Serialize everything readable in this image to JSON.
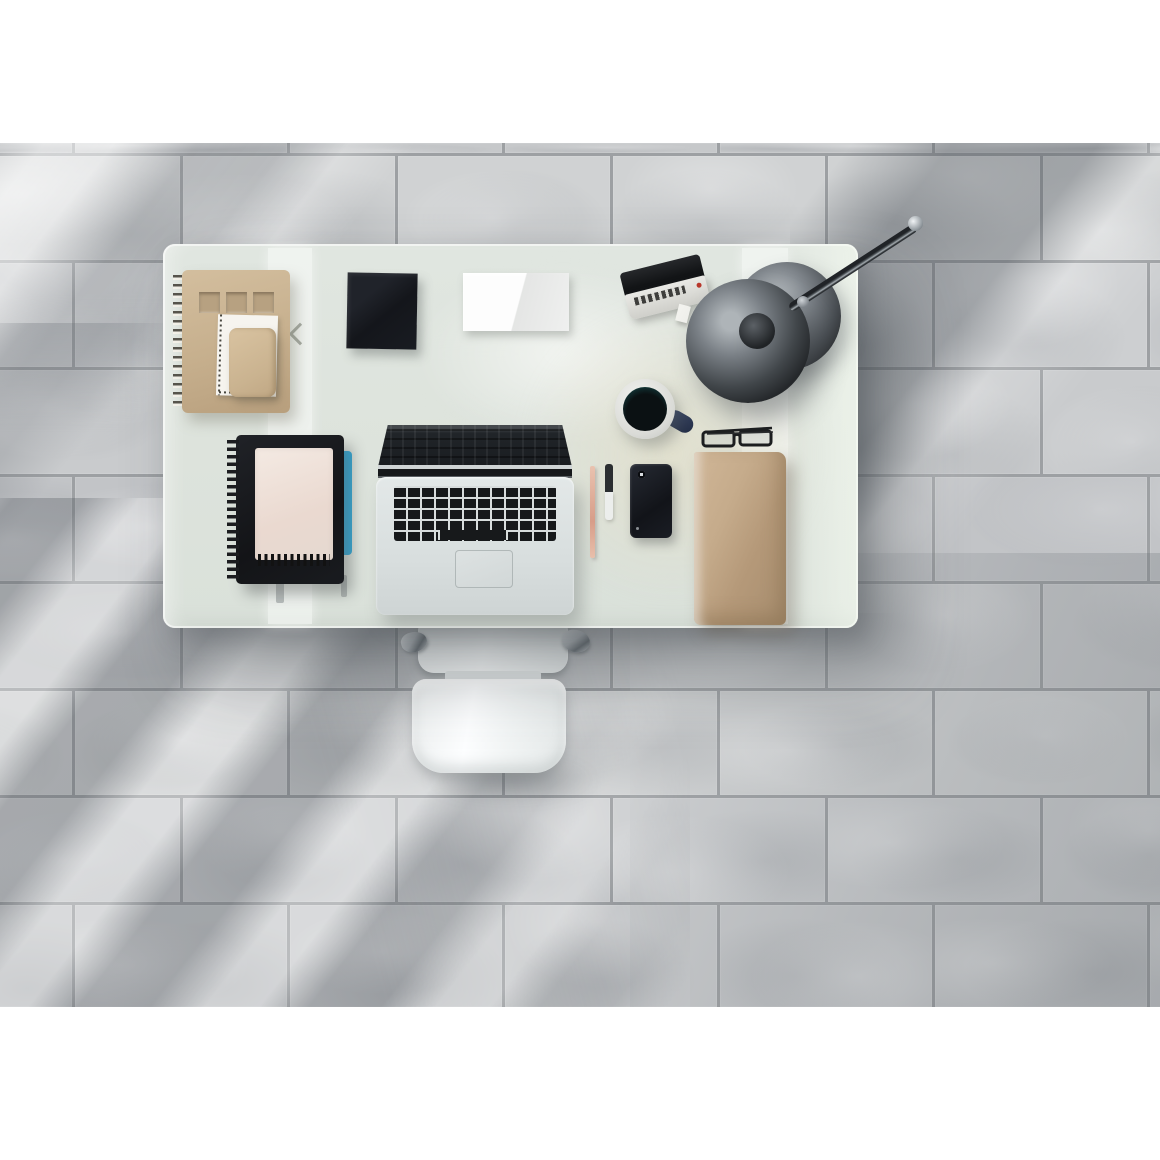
{
  "scene": {
    "description": "Overhead photo of a modern workspace: frosted glass desk with laptop and stationery on a gray stone tile floor, white office chair tucked under the desk, diagonal window light streaks across the tiles.",
    "photo_frame": {
      "top_margin_px": 143,
      "photo_height_px": 864,
      "margin_color": "#ffffff"
    }
  },
  "floor": {
    "label": "gray stone tile floor",
    "height": 864,
    "first_line": 10,
    "row_height": 107,
    "tile_w": 215,
    "grout": 3,
    "offsets": [
      72,
      180
    ],
    "grout_color": "#9da0a3",
    "palette": [
      "#c6c8ca",
      "#cdcfd1",
      "#c2c4c7",
      "#d0d2d3",
      "#c9cbcd"
    ]
  },
  "objects": {
    "floor": {
      "label": "gray stone tile floor"
    },
    "desk": {
      "label": "frosted glass desk"
    },
    "chair": {
      "label": "white office chair"
    },
    "laptop": {
      "label": "open laptop with black keyboard"
    },
    "spiral_notebook_tan": {
      "label": "tan spiral notebook with window cut-out cover"
    },
    "punch_card": {
      "label": "white perforated card"
    },
    "mini_notebook": {
      "label": "small kraft notebook"
    },
    "napkin_black": {
      "label": "black cloth napkin"
    },
    "folded_paper": {
      "label": "folded white paper"
    },
    "camera": {
      "label": "compact camera with tag"
    },
    "desk_lamp": {
      "label": "metal desk lamp with round shade and base"
    },
    "mug": {
      "label": "coffee mug with dark blue handle"
    },
    "glasses": {
      "label": "folded reading glasses"
    },
    "pen_rose": {
      "label": "rose gold pen"
    },
    "pen_white": {
      "label": "black pen with white cap"
    },
    "phone": {
      "label": "black smartphone lying face down"
    },
    "kraft_folder": {
      "label": "kraft paper folder"
    },
    "spiral_notebook_black": {
      "label": "black spiral notebook with cream notepad"
    }
  },
  "colors": {
    "desk_surface": "#dde3dc",
    "desk_warm_light": "#e5ddc2",
    "chair_white": "#f4f6f6",
    "laptop_deck": "#d8dede",
    "laptop_keys": "#17191b",
    "kraft": "#c5ab8b",
    "tan_notebook": "#c6af8d",
    "notepad_cream": "#f0e5de",
    "napkin": "#14161b",
    "mug_handle": "#2a3550",
    "mug_teal_rim": "#2d6b63",
    "blue_notebook_edge": "#2fa8d8",
    "lamp_metal_dark": "#2b2e31",
    "lamp_metal_light": "#aeb4b8",
    "tile_base": "#c6c8ca",
    "grout": "#9da0a3"
  }
}
